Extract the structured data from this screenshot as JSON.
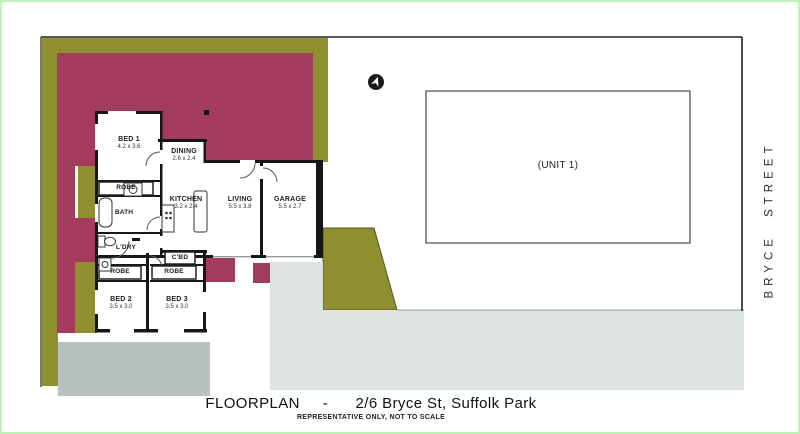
{
  "colors": {
    "site_olive": "#8f8f30",
    "site_maroon": "#a33c5c",
    "patio_grey": "#b6c3bd",
    "driveway_grey": "#dce3e0",
    "wall_black": "#161616"
  },
  "floorplan": {
    "rooms": [
      {
        "name": "BED 1",
        "dims": "4.2 x 3.6"
      },
      {
        "name": "DINING",
        "dims": "2.6 x 2.4"
      },
      {
        "name": "KITCHEN",
        "dims": "3.2 x 2.4"
      },
      {
        "name": "LIVING",
        "dims": "5.5 x 3.8"
      },
      {
        "name": "GARAGE",
        "dims": "5.5 x 2.7"
      },
      {
        "name": "BED 2",
        "dims": "3.5 x 3.0"
      },
      {
        "name": "BED 3",
        "dims": "3.5 x 3.0"
      }
    ],
    "small_rooms": [
      {
        "text": "ROBE"
      },
      {
        "text": "BATH"
      },
      {
        "text": "L'DRY"
      },
      {
        "text": "ROBE"
      },
      {
        "text": "C'BD"
      },
      {
        "text": "ROBE"
      }
    ],
    "unit_label": "(UNIT 1)"
  },
  "street_label": "BRYCE STREET",
  "footer": {
    "caption": "FLOORPLAN     -      2/6 Bryce St, Suffolk Park",
    "disclaimer": "REPRESENTATIVE ONLY, NOT TO SCALE"
  }
}
